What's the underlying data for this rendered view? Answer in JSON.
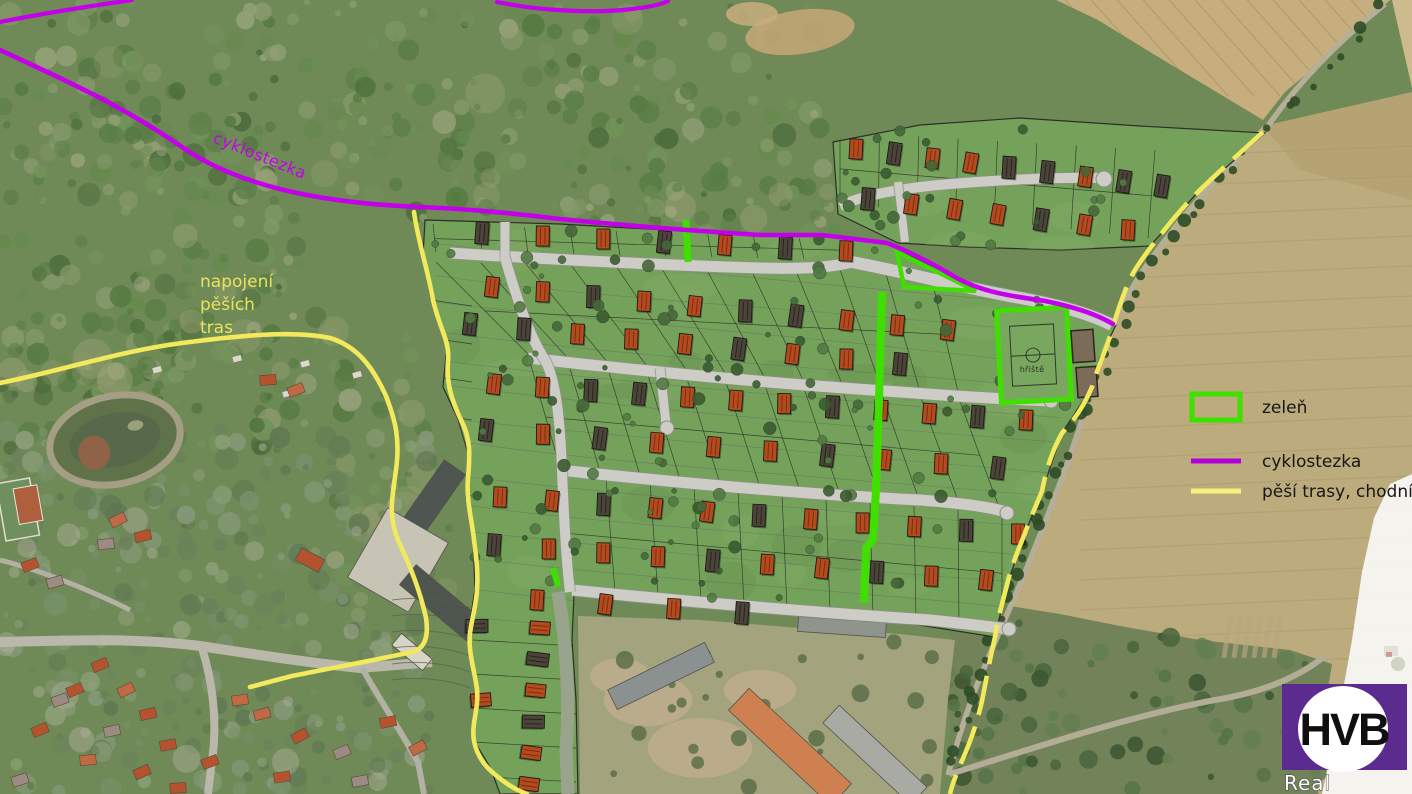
{
  "map_labels": {
    "cyklostezka": "cyklostezka",
    "note_lines": [
      "napojení",
      "pěších",
      "tras"
    ],
    "playground": "hřiště"
  },
  "legend": {
    "items": [
      {
        "label": "zeleň",
        "swatch": "rect",
        "color": "#3fe000"
      },
      {
        "label": "cyklostezka",
        "swatch": "line",
        "color": "#b400d8"
      },
      {
        "label": "pěší trasy, chodníky",
        "swatch": "line",
        "color": "#f7f07a"
      }
    ]
  },
  "logo": {
    "main": "HVB",
    "sub": "Real",
    "color": "#5b2b8f"
  },
  "palette": {
    "cyklostezka": "#c400ea",
    "pedestrian": "#f2e95c",
    "green_feature": "#3fe000",
    "parcel_green": "#75a25b",
    "road_gray": "#cdccc6",
    "field_tan": "#bfa97c",
    "note_yellow": "#e9e35e"
  },
  "site_plan": {
    "house_rows": [
      {
        "x1": 856,
        "y1": 149,
        "x2": 1162,
        "y2": 186,
        "n": 9,
        "t": "odooddodd"
      },
      {
        "x1": 868,
        "y1": 199,
        "x2": 1128,
        "y2": 230,
        "n": 7,
        "t": "dooodoo"
      },
      {
        "x1": 482,
        "y1": 233,
        "x2": 846,
        "y2": 251,
        "n": 7,
        "t": "doododo"
      },
      {
        "x1": 492,
        "y1": 287,
        "x2": 948,
        "y2": 330,
        "n": 10,
        "t": "oodooddooo"
      },
      {
        "x1": 470,
        "y1": 324,
        "x2": 900,
        "y2": 364,
        "n": 9,
        "t": "ddooodood"
      },
      {
        "x1": 494,
        "y1": 384,
        "x2": 1026,
        "y2": 420,
        "n": 12,
        "t": "ooddooodoodo"
      },
      {
        "x1": 486,
        "y1": 430,
        "x2": 998,
        "y2": 468,
        "n": 10,
        "t": "dodooodood"
      },
      {
        "x1": 500,
        "y1": 497,
        "x2": 1018,
        "y2": 534,
        "n": 11,
        "t": "oodoodooodo"
      },
      {
        "x1": 494,
        "y1": 545,
        "x2": 986,
        "y2": 580,
        "n": 10,
        "t": "dooodoodoo"
      },
      {
        "x1": 537,
        "y1": 600,
        "x2": 742,
        "y2": 613,
        "n": 4,
        "t": "oood"
      },
      {
        "x1": 540,
        "y1": 628,
        "x2": 529,
        "y2": 784,
        "n": 6,
        "t": "ododoo"
      },
      {
        "x1": 477,
        "y1": 626,
        "x2": 481,
        "y2": 700,
        "n": 2,
        "t": "do"
      }
    ]
  }
}
